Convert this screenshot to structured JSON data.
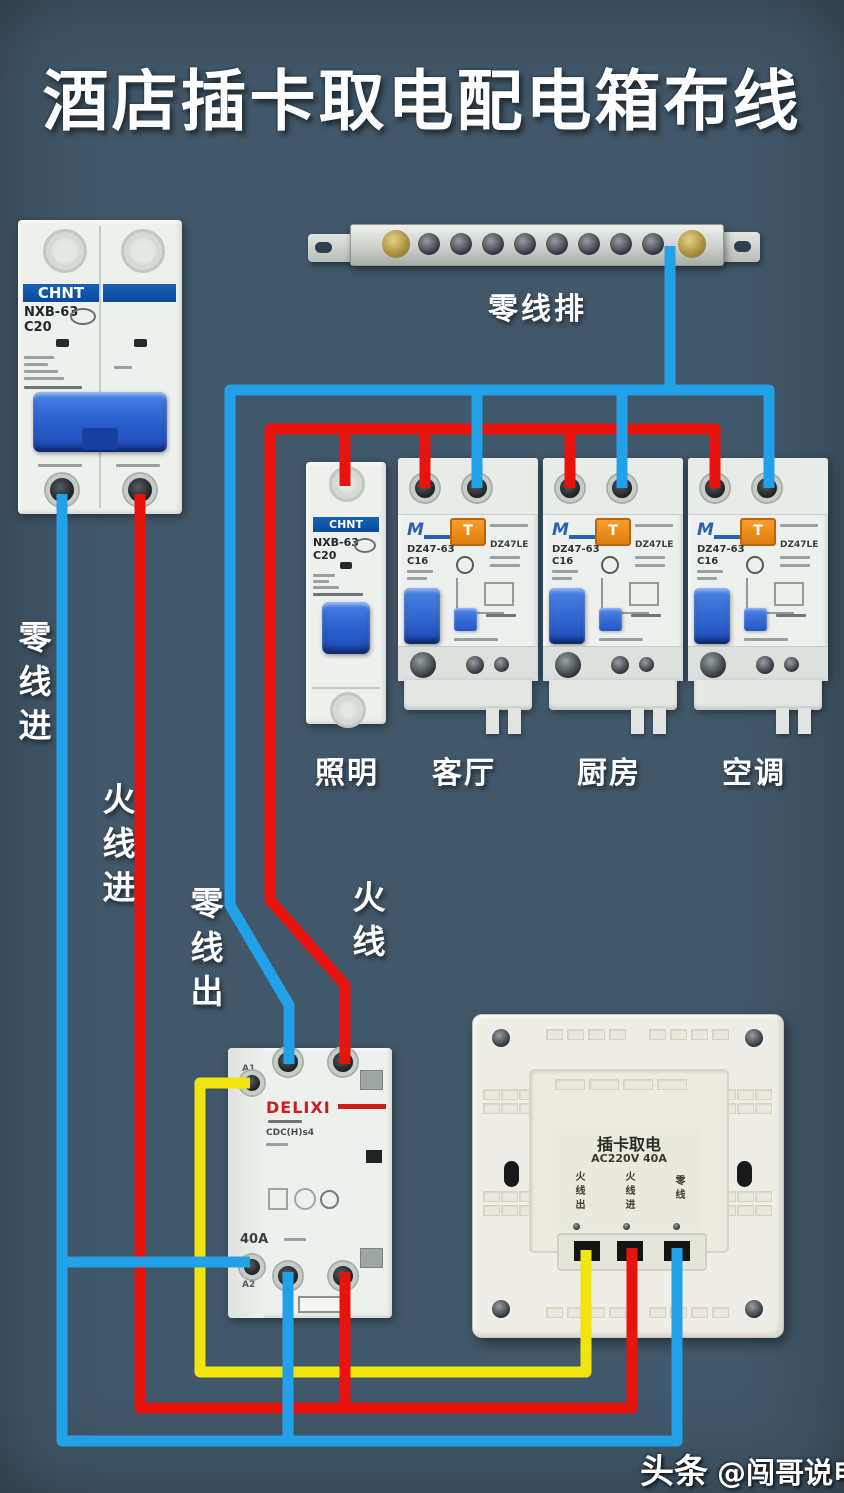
{
  "title": "酒店插卡取电配电箱布线",
  "watermark": {
    "brand": "头条",
    "account": "@闯哥说电气"
  },
  "neutral_bar": {
    "label": "零线排"
  },
  "wire_labels": {
    "neutral_in": "零线进",
    "live_in": "火线进",
    "neutral_out": "零线出",
    "live": "火线"
  },
  "main_breaker": {
    "brand": "CHNT",
    "model": "NXB-63",
    "rating": "C20"
  },
  "lighting_breaker": {
    "brand": "CHNT",
    "model": "NXB-63",
    "rating": "C20"
  },
  "rcbo": {
    "logo": "M",
    "model": "DZ47-63",
    "current": "C16",
    "type": "DZ47LE",
    "test_button": "T"
  },
  "circuits": [
    {
      "label": "照明"
    },
    {
      "label": "客厅"
    },
    {
      "label": "厨房"
    },
    {
      "label": "空调"
    }
  ],
  "contactor": {
    "brand": "DELIXI",
    "model": "CDC(H)s4",
    "rating": "40A",
    "terminal_a1": "A1",
    "terminal_a2": "A2"
  },
  "card_switch": {
    "title": "插卡取电",
    "rating": "AC220V 40A",
    "terminals": [
      "火线出",
      "火线进",
      "零线"
    ]
  },
  "colors": {
    "background": "#41586a",
    "wire_blue": "#22a0e8",
    "wire_red": "#e8130c",
    "wire_yellow": "#f2e40e",
    "brand_blue": "#0b49a0",
    "test_orange": "#ef8d18",
    "delixi_red": "#cf1d1d",
    "handle_blue": "#2e63d2"
  }
}
